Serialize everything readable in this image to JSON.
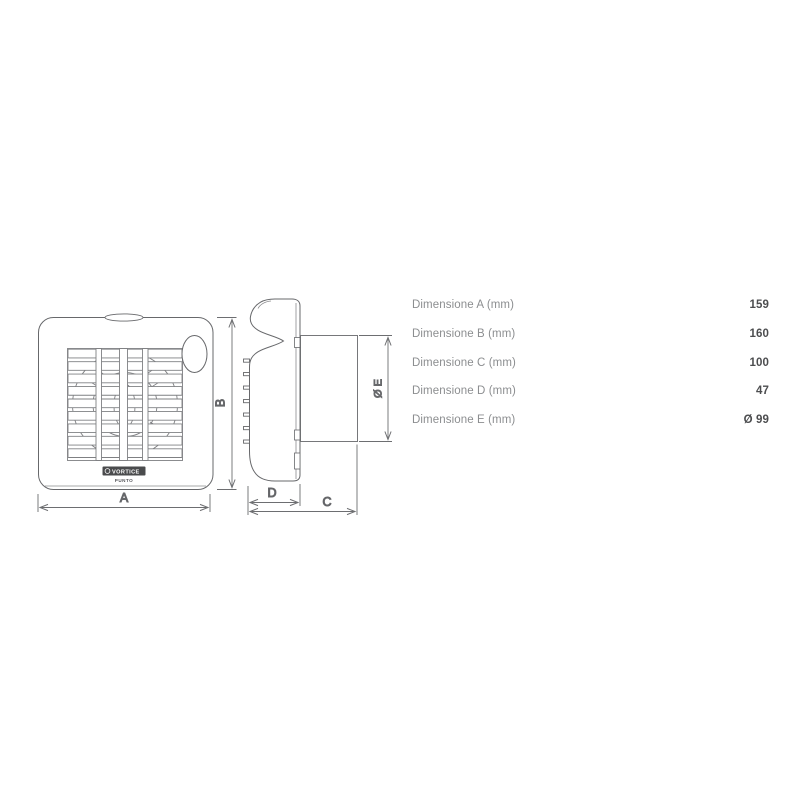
{
  "page": {
    "background_color": "#ffffff"
  },
  "drawing": {
    "line_color": "#6d6e71",
    "grille_line_color": "#7f8083",
    "front_view": {
      "label_a": "A",
      "label_b": "B",
      "logo_text": "VORTICE",
      "logo_sub": "PUNTO"
    },
    "side_view": {
      "label_c": "C",
      "label_d": "D",
      "label_e": "Ø E"
    }
  },
  "table": {
    "label_color": "#8c8e90",
    "value_color": "#4c4d4f",
    "rows": [
      {
        "label": "Dimensione A (mm)",
        "value": "159"
      },
      {
        "label": "Dimensione B (mm)",
        "value": "160"
      },
      {
        "label": "Dimensione C (mm)",
        "value": "100"
      },
      {
        "label": "Dimensione D (mm)",
        "value": "47"
      },
      {
        "label": "Dimensione E (mm)",
        "value": "Ø 99"
      }
    ]
  }
}
